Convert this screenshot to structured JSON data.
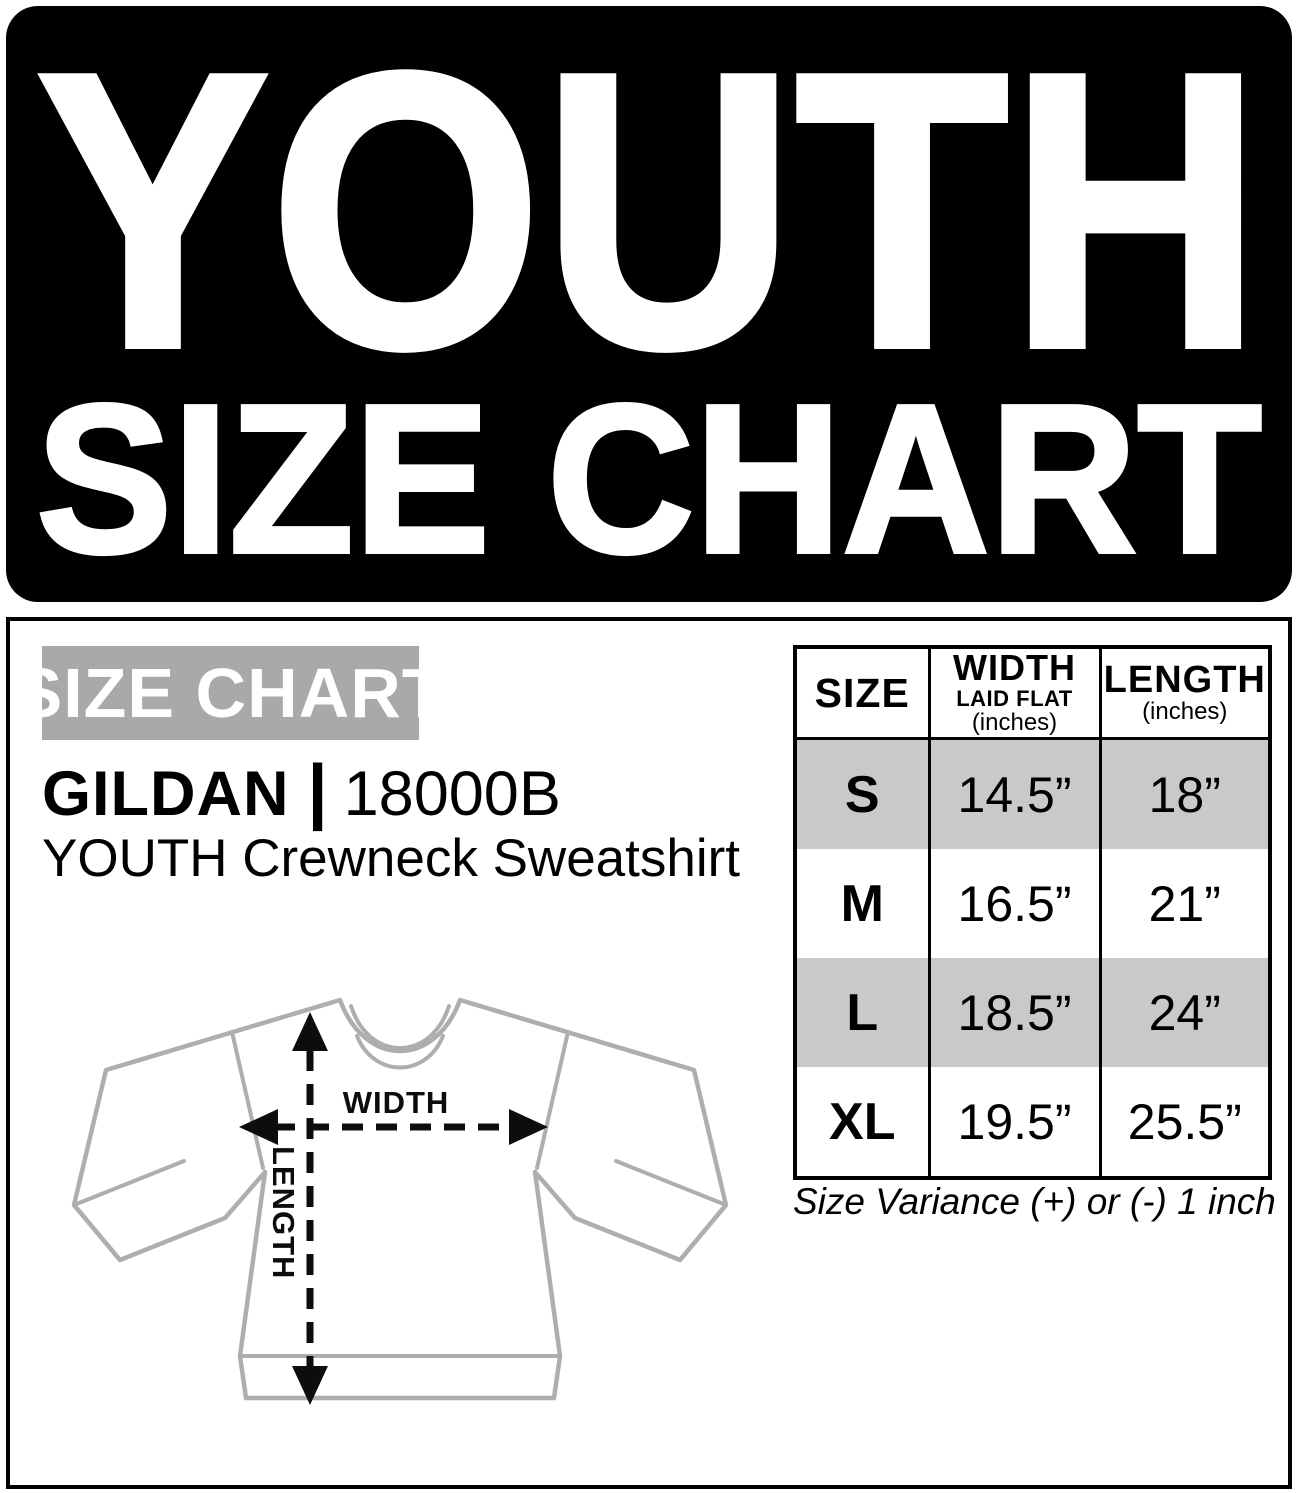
{
  "banner": {
    "line1": "YOUTH",
    "line2": "SIZE CHART",
    "bg_color": "#000000",
    "text_color": "#ffffff"
  },
  "left_panel": {
    "section_title": "SIZE CHART",
    "section_title_bg": "#a9a9a9",
    "brand": "GILDAN",
    "brand_separator": "|",
    "model": "18000B",
    "product": "YOUTH Crewneck Sweatshirt"
  },
  "diagram": {
    "width_label": "WIDTH",
    "length_label": "LENGTH",
    "outline_color": "#aeaeae",
    "arrow_color": "#0d0d0d"
  },
  "table": {
    "headers": {
      "size": "SIZE",
      "width_line1": "WIDTH",
      "width_line2": "LAID FLAT",
      "width_line3": "(inches)",
      "length_line1": "LENGTH",
      "length_line2": "(inches)"
    },
    "rows": [
      {
        "size": "S",
        "width": "14.5”",
        "length": "18”",
        "shaded": true
      },
      {
        "size": "M",
        "width": "16.5”",
        "length": "21”",
        "shaded": false
      },
      {
        "size": "L",
        "width": "18.5”",
        "length": "24”",
        "shaded": true
      },
      {
        "size": "XL",
        "width": "19.5”",
        "length": "25.5”",
        "shaded": false
      }
    ],
    "row_shade_color": "#c9c9c9",
    "variance_note": "Size Variance (+) or (-) 1 inch"
  }
}
